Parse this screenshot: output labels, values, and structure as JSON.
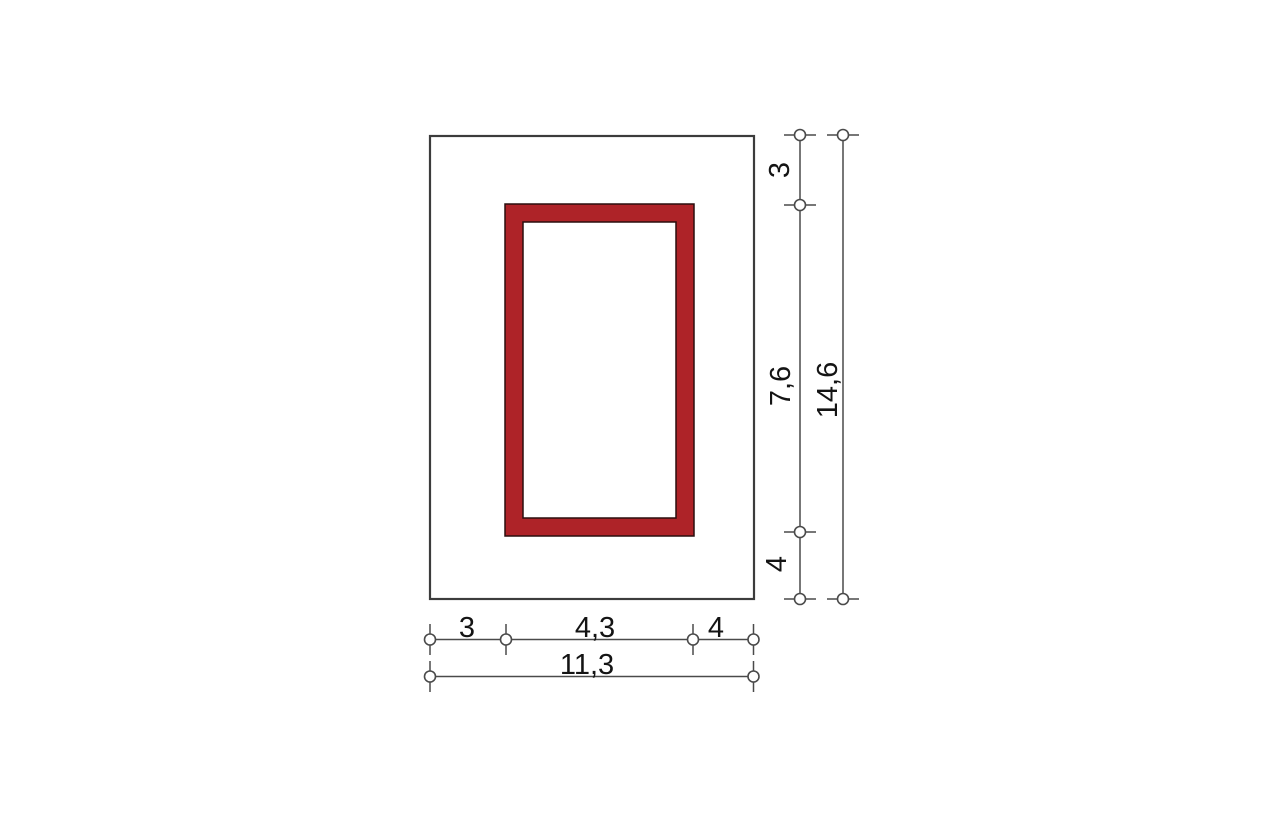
{
  "drawing": {
    "colors": {
      "background": "#FFFFFF",
      "outline": "#3C3C3C",
      "dimension_line": "#4A4A4A",
      "frame_fill": "#AE2328",
      "frame_outline": "#2A0E0E",
      "text": "#141414"
    },
    "dimensions": {
      "right": {
        "segments": [
          {
            "name": "top-offset",
            "label": "3"
          },
          {
            "name": "opening-height",
            "label": "7,6"
          },
          {
            "name": "bottom-offset",
            "label": "4"
          }
        ],
        "total": {
          "name": "total-height",
          "label": "14,6"
        }
      },
      "bottom": {
        "segments": [
          {
            "name": "left-offset",
            "label": "3"
          },
          {
            "name": "opening-width",
            "label": "4,3"
          },
          {
            "name": "right-offset",
            "label": "4"
          }
        ],
        "total": {
          "name": "total-width",
          "label": "11,3"
        }
      }
    }
  }
}
